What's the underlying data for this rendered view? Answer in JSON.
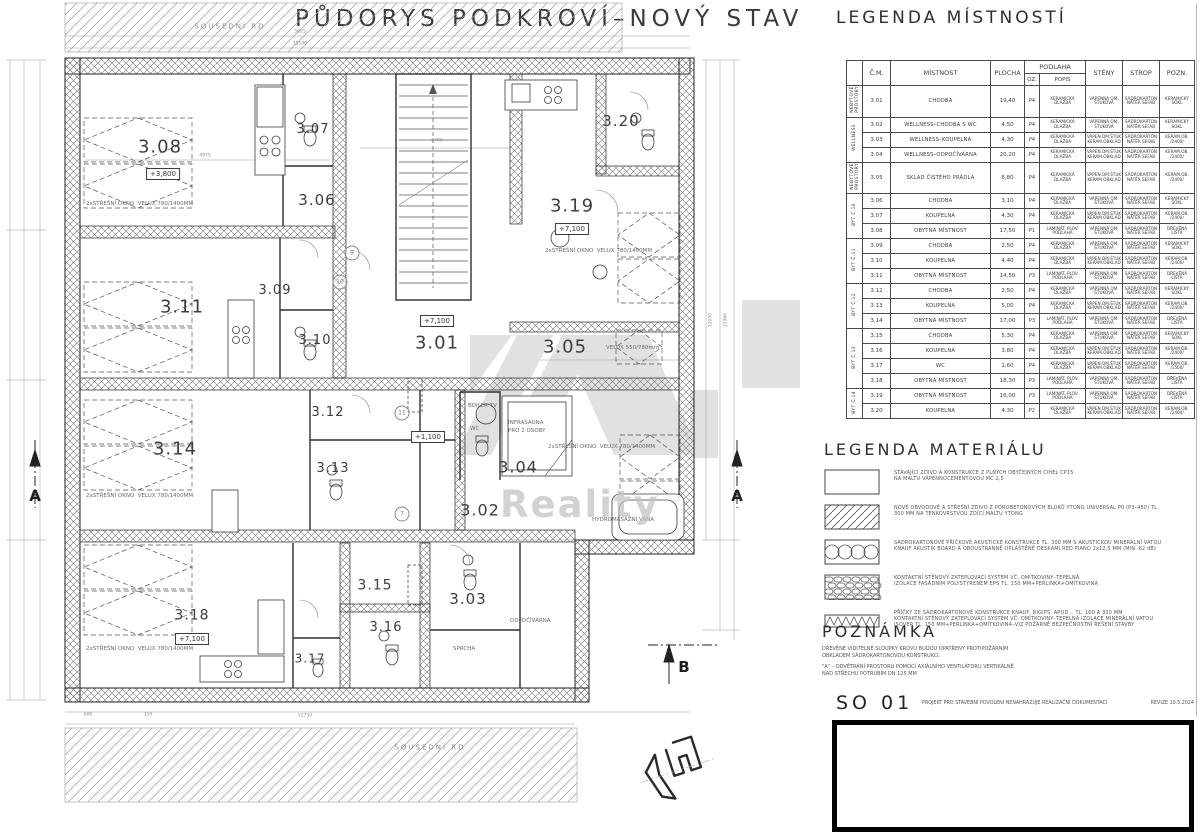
{
  "title": "PŮDORYS PODKROVÍ–NOVÝ STAV",
  "legend_table": {
    "title": "LEGENDA MÍSTNOSTÍ",
    "headers": {
      "cm": "Č.M.",
      "mistnost": "MÍSTNOST",
      "plocha": "PLOCHA",
      "podlaha": "PODLAHA",
      "oz": "OZ.",
      "popis": "POPIS",
      "steny": "STĚNY",
      "strop": "STROP",
      "pozn": "POZN."
    },
    "groups": [
      {
        "area": "25,30 M2",
        "name": "NEBYTOVÉ\nPROSTORY",
        "span": 1
      },
      {
        "area": "29,00 M2",
        "name": "WELLNESS",
        "span": 3
      },
      {
        "area": "19,70 M2",
        "name": "NEBYTOVÉ\nPROSTORY",
        "span": 1
      },
      {
        "area": "24,90 M2",
        "name": "BYT Č.10",
        "span": 3
      },
      {
        "area": "21,40 M2",
        "name": "BYT Č.11",
        "span": 3
      },
      {
        "area": "24,50 M2",
        "name": "BYT Č.12",
        "span": 3
      },
      {
        "area": "29,00 M2",
        "name": "BYT Č.13",
        "span": 4
      },
      {
        "area": "20,30 M2",
        "name": "BYT Č.14",
        "span": 2
      }
    ],
    "rows": [
      {
        "cm": "3.01",
        "mistnost": "CHODBA",
        "plocha": "19,40",
        "oz": "P4",
        "popis": "KERAMICKÁ\nDLAŽBA",
        "steny": "VÁPENNÁ OM.\nŠTUKOVÁ",
        "strop": "SÁDROKARTON\nNÁTĚR SEFAB",
        "pozn": "KERAMICKÝ\nSOKL"
      },
      {
        "cm": "3.02",
        "mistnost": "WELLNESS–CHODBA S WC",
        "plocha": "4,50",
        "oz": "P4",
        "popis": "KERAMICKÁ\nDLAŽBA",
        "steny": "VÁPENNÁ OM.\nŠTUKOVÁ",
        "strop": "SÁDROKARTON\nNÁTĚR SEFAB",
        "pozn": "KERAMICKÝ\nSOKL"
      },
      {
        "cm": "3.03",
        "mistnost": "WELLNESS–KOUPELNA",
        "plocha": "4,30",
        "oz": "P4",
        "popis": "KERAMICKÁ\nDLAŽBA",
        "steny": "VÁPEN.OM.ŠTUK\nKERAM.OBKLAD",
        "strop": "SÁDROKARTON\nNÁTĚR SEFAB",
        "pozn": "KERAM.OB.\n/2400/"
      },
      {
        "cm": "3.04",
        "mistnost": "WELLNESS–ODPOČÍVÁRNA",
        "plocha": "20,20",
        "oz": "P4",
        "popis": "KERAMICKÁ\nDLAŽBA",
        "steny": "VÁPEN.OM.ŠTUK\nKERAM.OBKLAD",
        "strop": "SÁDROKARTON\nNÁTĚR SEFAB",
        "pozn": "KERAM.OB.\n/2400/"
      },
      {
        "cm": "3.05",
        "mistnost": "SKLAD ČISTÉHO PRÁDLA",
        "plocha": "6,80",
        "oz": "P4",
        "popis": "KERAMICKÁ\nDLAŽBA",
        "steny": "VÁPEN.OM.ŠTUK\nKERAM.OBKLAD",
        "strop": "SÁDROKARTON\nNÁTĚR SEFAB",
        "pozn": "KERAM.OB.\n/2400/"
      },
      {
        "cm": "3.06",
        "mistnost": "CHODBA",
        "plocha": "3,10",
        "oz": "P4",
        "popis": "KERAMICKÁ\nDLAŽBA",
        "steny": "VÁPENNÁ OM.\nŠTUKOVÁ",
        "strop": "SÁDROKARTON\nNÁTĚR SEFAB",
        "pozn": "KERAMICKÝ\nSOKL"
      },
      {
        "cm": "3.07",
        "mistnost": "KOUPELNA",
        "plocha": "4,30",
        "oz": "P4",
        "popis": "KERAMICKÁ\nDLAŽBA",
        "steny": "VÁPEN.OM.ŠTUK\nKERAM.OBKLAD",
        "strop": "SÁDROKARTON\nNÁTĚR SEFAB",
        "pozn": "KERAM.OB.\n/2400/"
      },
      {
        "cm": "3.08",
        "mistnost": "OBYTNÁ MÍSTNOST",
        "plocha": "17,50",
        "oz": "P1",
        "popis": "LAMINÁT. PLOV.\nPODLAHA",
        "steny": "VÁPENNÁ OM.\nŠTUKOVÁ",
        "strop": "SÁDROKARTON\nNÁTĚR SEFAB",
        "pozn": "DŘEVĚNÁ\nLIŠTA"
      },
      {
        "cm": "3.09",
        "mistnost": "CHODBA",
        "plocha": "2,50",
        "oz": "P4",
        "popis": "KERAMICKÁ\nDLAŽBA",
        "steny": "VÁPENNÁ OM.\nŠTUKOVÁ",
        "strop": "SÁDROKARTON\nNÁTĚR SEFAB",
        "pozn": "KERAMICKÝ\nSOKL"
      },
      {
        "cm": "3.10",
        "mistnost": "KOUPELNA",
        "plocha": "4,40",
        "oz": "P4",
        "popis": "KERAMICKÁ\nDLAŽBA",
        "steny": "VÁPEN.OM.ŠTUK\nKERAM.OBKLAD",
        "strop": "SÁDROKARTON\nNÁTĚR SEFAB",
        "pozn": "KERAM.OB.\n/2400/"
      },
      {
        "cm": "3.11",
        "mistnost": "OBYTNÁ MÍSTNOST",
        "plocha": "14,50",
        "oz": "P3",
        "popis": "LAMINÁT. PLOV.\nPODLAHA",
        "steny": "VÁPENNÁ OM.\nŠTUKOVÁ",
        "strop": "SÁDROKARTON\nNÁTĚR SEFAB",
        "pozn": "DŘEVĚNÁ\nLIŠTA"
      },
      {
        "cm": "3.12",
        "mistnost": "CHODBA",
        "plocha": "2,50",
        "oz": "P4",
        "popis": "KERAMICKÁ\nDLAŽBA",
        "steny": "VÁPENNÁ OM.\nŠTUKOVÁ",
        "strop": "SÁDROKARTON\nNÁTĚR SEFAB",
        "pozn": "KERAMICKÝ\nSOKL"
      },
      {
        "cm": "3.13",
        "mistnost": "KOUPELNA",
        "plocha": "5,00",
        "oz": "P4",
        "popis": "KERAMICKÁ\nDLAŽBA",
        "steny": "VÁPEN.OM.ŠTUK\nKERAM.OBKLAD",
        "strop": "SÁDROKARTON\nNÁTĚR SEFAB",
        "pozn": "KERAM.OB.\n/2400/"
      },
      {
        "cm": "3.14",
        "mistnost": "OBYTNÁ MÍSTNOST",
        "plocha": "17,00",
        "oz": "P3",
        "popis": "LAMINÁT. PLOV.\nPODLAHA",
        "steny": "VÁPENNÁ OM.\nŠTUKOVÁ",
        "strop": "SÁDROKARTON\nNÁTĚR SEFAB",
        "pozn": "DŘEVĚNÁ\nLIŠTA"
      },
      {
        "cm": "3.15",
        "mistnost": "CHODBA",
        "plocha": "5,30",
        "oz": "P4",
        "popis": "KERAMICKÁ\nDLAŽBA",
        "steny": "VÁPENNÁ OM.\nŠTUKOVÁ",
        "strop": "SÁDROKARTON\nNÁTĚR SEFAB",
        "pozn": "KERAMICKÝ\nSOKL"
      },
      {
        "cm": "3.16",
        "mistnost": "KOUPELNA",
        "plocha": "3,80",
        "oz": "P4",
        "popis": "KERAMICKÁ\nDLAŽBA",
        "steny": "VÁPEN.OM.ŠTUK\nKERAM.OBKLAD",
        "strop": "SÁDROKARTON\nNÁTĚR SEFAB",
        "pozn": "KERAM.OB.\n/2400/"
      },
      {
        "cm": "3.17",
        "mistnost": "WC",
        "plocha": "1,60",
        "oz": "P4",
        "popis": "KERAMICKÁ\nDLAŽBA",
        "steny": "VÁPEN.OM.ŠTUK\nKERAM.OBKLAD",
        "strop": "SÁDROKARTON\nNÁTĚR SEFAB",
        "pozn": "KERAM.OB.\n/1500/"
      },
      {
        "cm": "3.18",
        "mistnost": "OBYTNÁ MÍSTNOST",
        "plocha": "18,30",
        "oz": "P3",
        "popis": "LAMINÁT. PLOV.\nPODLAHA",
        "steny": "VÁPENNÁ OM.\nŠTUKOVÁ",
        "strop": "SÁDROKARTON\nNÁTĚR SEFAB",
        "pozn": "DŘEVĚNÁ\nLIŠTA"
      },
      {
        "cm": "3.19",
        "mistnost": "OBYTNÁ MÍSTNOST",
        "plocha": "16,00",
        "oz": "P3",
        "popis": "LAMINÁT. PLOV.\nPODLAHA",
        "steny": "VÁPENNÁ OM.\nŠTUKOVÁ",
        "strop": "SÁDROKARTON\nNÁTĚR SEFAB",
        "pozn": "DŘEVĚNÁ\nLIŠTA"
      },
      {
        "cm": "3.20",
        "mistnost": "KOUPELNA",
        "plocha": "4,30",
        "oz": "P2",
        "popis": "KERAMICKÁ\nDLAŽBA",
        "steny": "VÁPEN.OM.ŠTUK\nKERAM.OBKLAD",
        "strop": "SÁDROKARTON\nNÁTĚR SEFAB",
        "pozn": "KERAM.OB.\n/2400/"
      }
    ]
  },
  "materials": {
    "title": "LEGENDA MATERIÁLU",
    "items": [
      {
        "symbol": "plain",
        "text": "STÁVAJÍCÍ ZDIVO A KONSTRUKCE Z PLNÝCH OBYČEJNÝCH CIHEL CP15\nNA MALTU VÁPENNOCEMENTOVOU MC 2,5"
      },
      {
        "symbol": "diag",
        "text": "NOVÉ OBVODOVÉ A STŘEŠNÍ ZDIVO Z PÓROBETONOVÝCH BLOKŮ YTONG UNIVERSAL P0 (P3–450) TL.\n300 MM NA TENKOVRSTVOU ZDÍCÍ MALTU YTONG"
      },
      {
        "symbol": "loops",
        "text": "SÁDROKARTONOVÉ PŘÍČKOVÉ AKUSTICKÉ KONSTRUKCE TL. 300 MM S AKUSTICKOU MINERÁLNÍ VATOU\nKNAUF AKUSTIK BOARD A OBOUSTRANNĚ OPLÁŠTĚNÉ DESKAMI RED PIANO 2x12,5 MM (MIN. 62 dB)"
      },
      {
        "symbol": "bricks",
        "text": "KONTAKTNÍ STĚNOVÝ ZATEPLOVACÍ SYSTÉM VČ. OMÍTKOVINY–TEPELNÁ\nIZOLACE FASÁDNÍM POLYSTYRENEM EPS TL. 150 MM+PERLINKA+OMÍTKOVINA"
      },
      {
        "symbol": "zigzag",
        "text": "PŘÍČKY ZE SÁDROKARTONOVÉ KONSTRUKCE KNAUF, RIGIPS, APOD... TL. 100 A 300 MM\nKONTAKTNÍ STĚNOVÝ ZATEPLOVACÍ SYSTÉM VČ. OMÍTKOVINY–TEPELNÁ IZOLACE MINERÁLNÍ VATOU\nISOVER TL. 150 MM+PERLINKA+OMÍTKOVINA–VIZ POŽÁRNĚ BEZPEČNOSTNÍ ŘEŠENÍ STAVBY"
      }
    ]
  },
  "note": {
    "title": "POZNÁMKA",
    "lines": [
      "DŘEVĚNÉ VIDITELNÉ SLOUPKY KROVU BUDOU OPATŘENY PROTIPOŽÁRNÍM\nOBKLADEM SÁDROKARTONOVOU KONSTRUKCÍ.",
      "\"A\" – ODVĚTRÁNÍ PROSTORU POMOCÍ AXIÁLNÍHO VENTILÁTORU VERTIKÁLNĚ\nNAD STŘECHU POTRUBÍM DN 125 MM"
    ]
  },
  "footer": {
    "code": "SO 01",
    "text": "PROJEKT PRO STAVEBNÍ POVOLENÍ NENAHRAZUJE REALIZAČNÍ DOKUMENTACI",
    "revision": "REVIZE 10.5.2024"
  },
  "plan": {
    "watermark": {
      "text": "Reality"
    },
    "labels": [
      {
        "t": "3.08",
        "x": 160,
        "y": 148,
        "s": 18,
        "cls": "room"
      },
      {
        "t": "3.07",
        "x": 313,
        "y": 130,
        "s": 13,
        "cls": "room"
      },
      {
        "t": "3.06",
        "x": 317,
        "y": 201,
        "s": 15,
        "cls": "room"
      },
      {
        "t": "3.20",
        "x": 621,
        "y": 122,
        "s": 15,
        "cls": "room"
      },
      {
        "t": "3.19",
        "x": 572,
        "y": 207,
        "s": 18,
        "cls": "room"
      },
      {
        "t": "3.01",
        "x": 437,
        "y": 344,
        "s": 18,
        "cls": "room"
      },
      {
        "t": "3.05",
        "x": 565,
        "y": 348,
        "s": 18,
        "cls": "room"
      },
      {
        "t": "3.11",
        "x": 182,
        "y": 308,
        "s": 18,
        "cls": "room"
      },
      {
        "t": "3.09",
        "x": 275,
        "y": 291,
        "s": 13,
        "cls": "room"
      },
      {
        "t": "3.10",
        "x": 315,
        "y": 341,
        "s": 13,
        "cls": "room"
      },
      {
        "t": "3.12",
        "x": 328,
        "y": 413,
        "s": 13,
        "cls": "room"
      },
      {
        "t": "3.13",
        "x": 333,
        "y": 469,
        "s": 13,
        "cls": "room"
      },
      {
        "t": "3.14",
        "x": 175,
        "y": 450,
        "s": 18,
        "cls": "room"
      },
      {
        "t": "3.04",
        "x": 518,
        "y": 468,
        "s": 16,
        "cls": "room"
      },
      {
        "t": "3.02",
        "x": 480,
        "y": 511,
        "s": 16,
        "cls": "room"
      },
      {
        "t": "3.03",
        "x": 468,
        "y": 600,
        "s": 15,
        "cls": "room"
      },
      {
        "t": "3.15",
        "x": 375,
        "y": 586,
        "s": 14,
        "cls": "room"
      },
      {
        "t": "3.16",
        "x": 386,
        "y": 628,
        "s": 13,
        "cls": "room"
      },
      {
        "t": "3.17",
        "x": 310,
        "y": 659,
        "s": 12,
        "cls": "room"
      },
      {
        "t": "3.18",
        "x": 192,
        "y": 616,
        "s": 14,
        "cls": "room"
      },
      {
        "t": "2xSTŘEŠNÍ OKNO  VELUX 780/1400MM",
        "x": 86,
        "y": 205,
        "s": 5.5,
        "cls": "ann",
        "a": "l"
      },
      {
        "t": "2xSTŘEŠNÍ OKNO  VELUX 780/1400MM",
        "x": 86,
        "y": 497,
        "s": 5.5,
        "cls": "ann",
        "a": "l"
      },
      {
        "t": "2xSTŘEŠNÍ OKNO  VELUX 780/1400MM",
        "x": 86,
        "y": 650,
        "s": 5.5,
        "cls": "ann",
        "a": "l"
      },
      {
        "t": "2xSTŘEŠNÍ OKNO  VELUX 780/1400MM",
        "x": 545,
        "y": 252,
        "s": 5.5,
        "cls": "ann",
        "a": "l"
      },
      {
        "t": "2xSTŘEŠNÍ OKNO  VELUX 780/1400MM",
        "x": 548,
        "y": 448,
        "s": 5.5,
        "cls": "ann",
        "a": "l"
      },
      {
        "t": "VELUX 550/780mm",
        "x": 606,
        "y": 349,
        "s": 5.5,
        "cls": "ann",
        "a": "l"
      },
      {
        "t": "INFRASAUNA",
        "x": 508,
        "y": 424,
        "s": 5.5,
        "cls": "ann",
        "a": "l"
      },
      {
        "t": "PRO 2 OSOBY",
        "x": 508,
        "y": 432,
        "s": 5.5,
        "cls": "ann",
        "a": "l"
      },
      {
        "t": "BOILER TV",
        "x": 468,
        "y": 407,
        "s": 5.5,
        "cls": "ann",
        "a": "l"
      },
      {
        "t": "WC",
        "x": 470,
        "y": 430,
        "s": 5.5,
        "cls": "ann",
        "a": "l"
      },
      {
        "t": "HYDROMASÁŽNÍ VANA",
        "x": 592,
        "y": 521,
        "s": 5.5,
        "cls": "ann",
        "a": "l"
      },
      {
        "t": "ODPOČÍVÁRNA",
        "x": 510,
        "y": 622,
        "s": 5.5,
        "cls": "ann",
        "a": "l"
      },
      {
        "t": "SPRCHA",
        "x": 453,
        "y": 650,
        "s": 5.5,
        "cls": "ann",
        "a": "l"
      },
      {
        "t": "SOUSEDNÍ RD",
        "x": 230,
        "y": 27,
        "s": 7,
        "cls": "band"
      },
      {
        "t": "SOUSEDNÍ RD",
        "x": 430,
        "y": 748,
        "s": 7,
        "cls": "band"
      },
      {
        "t": "5625",
        "x": 300,
        "y": 33,
        "s": 4.5,
        "cls": "dim"
      },
      {
        "t": "15100",
        "x": 300,
        "y": 45,
        "s": 4.5,
        "cls": "dim"
      },
      {
        "t": "4975",
        "x": 205,
        "y": 157,
        "s": 4.5,
        "cls": "dim"
      },
      {
        "t": "2700",
        "x": 437,
        "y": 142,
        "s": 4.5,
        "cls": "dim"
      },
      {
        "t": "12750",
        "x": 305,
        "y": 717,
        "s": 4.5,
        "cls": "dim"
      },
      {
        "t": "600",
        "x": 88,
        "y": 716,
        "s": 4.5,
        "cls": "dim"
      },
      {
        "t": "150",
        "x": 148,
        "y": 716,
        "s": 4.5,
        "cls": "dim"
      },
      {
        "t": "12050",
        "x": 712,
        "y": 320,
        "s": 4.5,
        "cls": "dim",
        "r": true
      },
      {
        "t": "12360",
        "x": 727,
        "y": 320,
        "s": 4.5,
        "cls": "dim",
        "r": true
      },
      {
        "t": "A",
        "x": 35,
        "y": 497,
        "s": 15,
        "cls": "sect"
      },
      {
        "t": "A",
        "x": 737,
        "y": 497,
        "s": 15,
        "cls": "sect"
      },
      {
        "t": "B",
        "x": 684,
        "y": 668,
        "s": 15,
        "cls": "sect"
      }
    ],
    "elevations": [
      {
        "t": "+3,800",
        "x": 163,
        "y": 174
      },
      {
        "t": "+7,100",
        "x": 572,
        "y": 229
      },
      {
        "t": "+7,100",
        "x": 437,
        "y": 321
      },
      {
        "t": "+1,100",
        "x": 428,
        "y": 437
      },
      {
        "t": "+7,100",
        "x": 192,
        "y": 639
      }
    ],
    "bubbles": [
      {
        "n": "9",
        "x": 352,
        "y": 253
      },
      {
        "n": "10",
        "x": 340,
        "y": 282
      },
      {
        "n": "11",
        "x": 402,
        "y": 413
      },
      {
        "n": "7",
        "x": 402,
        "y": 514
      }
    ]
  }
}
